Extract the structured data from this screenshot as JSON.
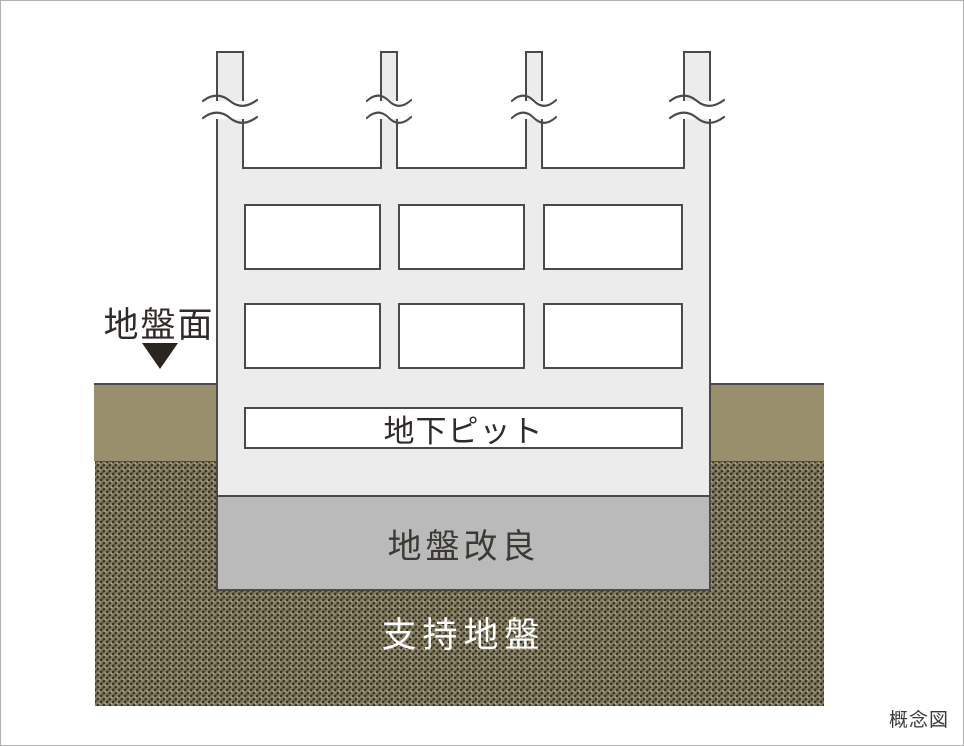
{
  "figure": {
    "caption": "概念図",
    "ground_surface_label": "地盤面",
    "pit_label": "地下ピット",
    "improvement_label": "地盤改良",
    "bearing_label": "支持地盤"
  },
  "icons": {
    "ground_surface_marker": "triangle-down-icon",
    "column_break": "break-mark-icon"
  },
  "colors": {
    "building_fill": "#ececec",
    "outline": "#4a4a4a",
    "improvement_fill": "#bababa",
    "soil_fill": "#9a8f6c",
    "bearing_fill": "#8b8264",
    "bearing_dot": "#383528",
    "marker_color": "#2a251e",
    "text_dark": "#302b28",
    "text_light": "#ffffff",
    "caption_color": "#3a3a3a",
    "frame_border": "#b0b0b0"
  }
}
